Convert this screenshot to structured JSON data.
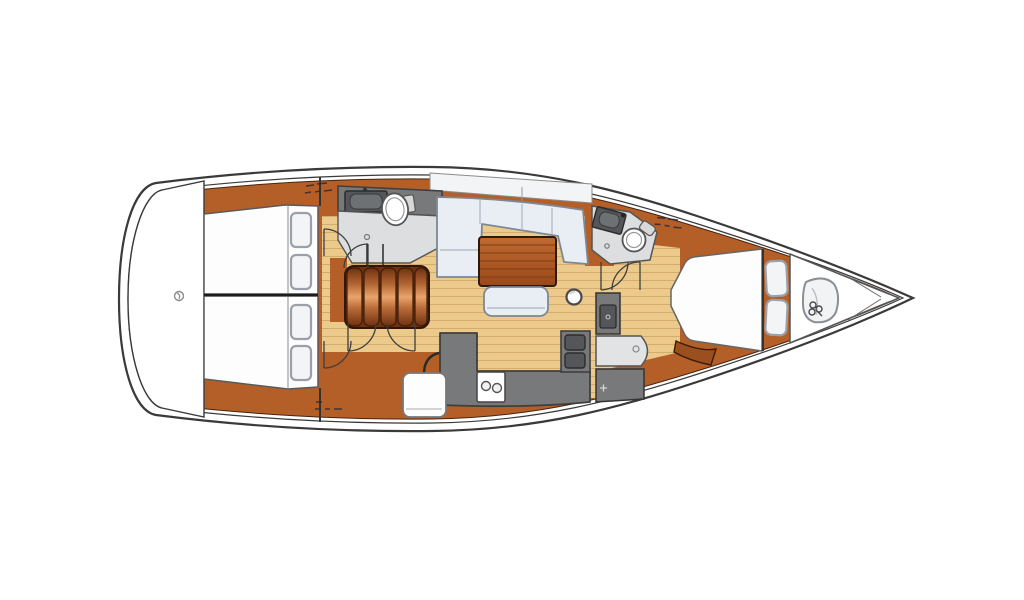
{
  "diagram": {
    "type": "sailing-yacht-interior-floorplan",
    "orientation": "bow-right-stern-left",
    "rooms": [
      "transom-swim-platform",
      "aft-cabin-port",
      "aft-cabin-starboard",
      "aft-head",
      "companionway-steps",
      "salon",
      "galley",
      "nav-station",
      "forward-head",
      "forward-cabin",
      "forepeak-sail-locker"
    ],
    "fixtures": [
      "aft-toilet",
      "aft-sink",
      "forward-toilet",
      "forward-sink",
      "stove-two-burners",
      "galley-double-sink",
      "chart-table",
      "nav-seat",
      "salon-settee",
      "salon-table",
      "salon-bench",
      "round-stool",
      "double-berth-port",
      "double-berth-starboard",
      "v-berth",
      "pillows",
      "sail-bag"
    ]
  },
  "palette": {
    "page_bg": "#ffffff",
    "hull_stroke": "#3a3a3a",
    "wood": "#b45f28",
    "wood_dark": "#9c4f1e",
    "wood_outline": "#4a2410",
    "floor_tan": "#ecca8b",
    "plank": "#c79d5e",
    "upholstery": "#e9eef5",
    "upholstery_stroke": "#7d8795",
    "table_light": "#c06a30",
    "table_dark": "#9a481b",
    "table_line": "#7e3d15",
    "counter": "#77797a",
    "counter_edge": "#3f3f3f",
    "basin": "#54565a",
    "head_floor": "#dcdedf",
    "fixture_stroke": "#555555",
    "white_fixture": "#fdfdfe",
    "pillow": "#f3f4f6",
    "pillow_stroke": "#9aa0a8",
    "step_dark": "#6f3110",
    "step_mid": "#b86a38",
    "step_light": "#e9a46b",
    "door_arc": "#3e3e3e",
    "coachroof": "#f2f4f6",
    "bag_stroke": "#8a8f96",
    "glyph_grey": "#8a8a8a",
    "bulkhead": "#1c1c1c"
  },
  "icons": [
    "transom-shackle-icon",
    "aft-sink-faucet-icon",
    "forward-sink-faucet-icon",
    "stove-burner-icon",
    "floor-drain-icon",
    "nav-instrument-icon",
    "seat-cleat-icon",
    "sail-bag-clover-icon"
  ],
  "labels": {
    "note": "three tiny illegible berth-dimension annotations printed on the wood"
  }
}
